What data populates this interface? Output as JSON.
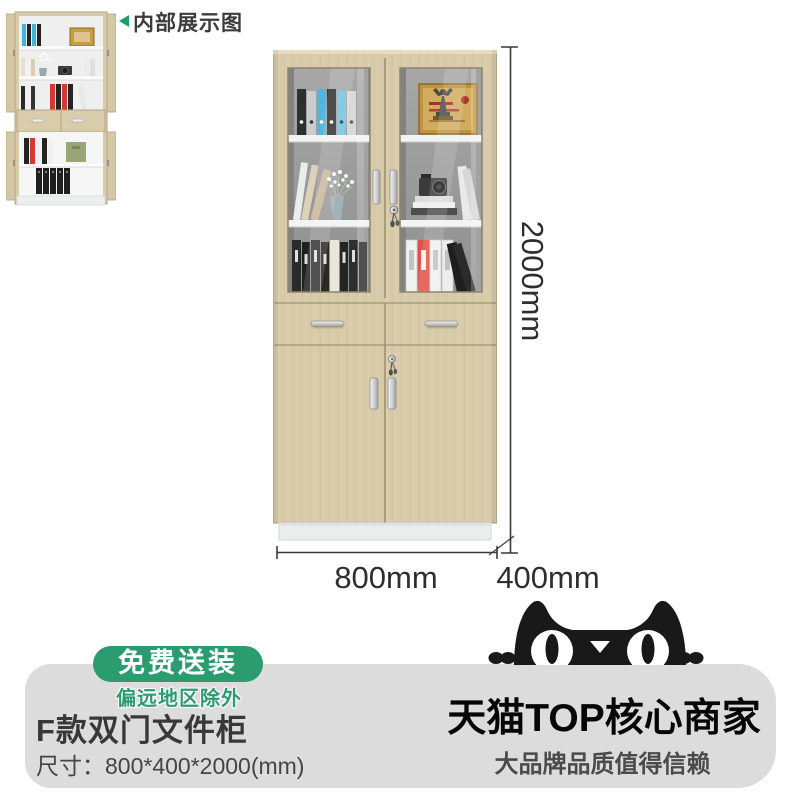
{
  "thumb": {
    "label": "内部展示图"
  },
  "dims": {
    "height": "2000mm",
    "width": "800mm",
    "depth": "400mm"
  },
  "promo": {
    "free_badge": "免费送装",
    "free_note": "偏远地区除外",
    "title": "F款双门文件柜",
    "size": "尺寸：800*400*2000(mm)"
  },
  "brand": {
    "headline": "天猫TOP核心商家",
    "tagline": "大品牌品质值得信赖"
  },
  "colors": {
    "accent_green": "#2a9c70",
    "panel_gray": "#dcdcdc",
    "cabinet_wood": "#d7cbaa",
    "glass_gray": "#9d9d9d",
    "dimension_line": "#3a3a3a",
    "cat_black": "#191919",
    "red_binder": "#d9473b",
    "blue_binder": "#52b6de",
    "gold_plaque": "#bf9441"
  }
}
